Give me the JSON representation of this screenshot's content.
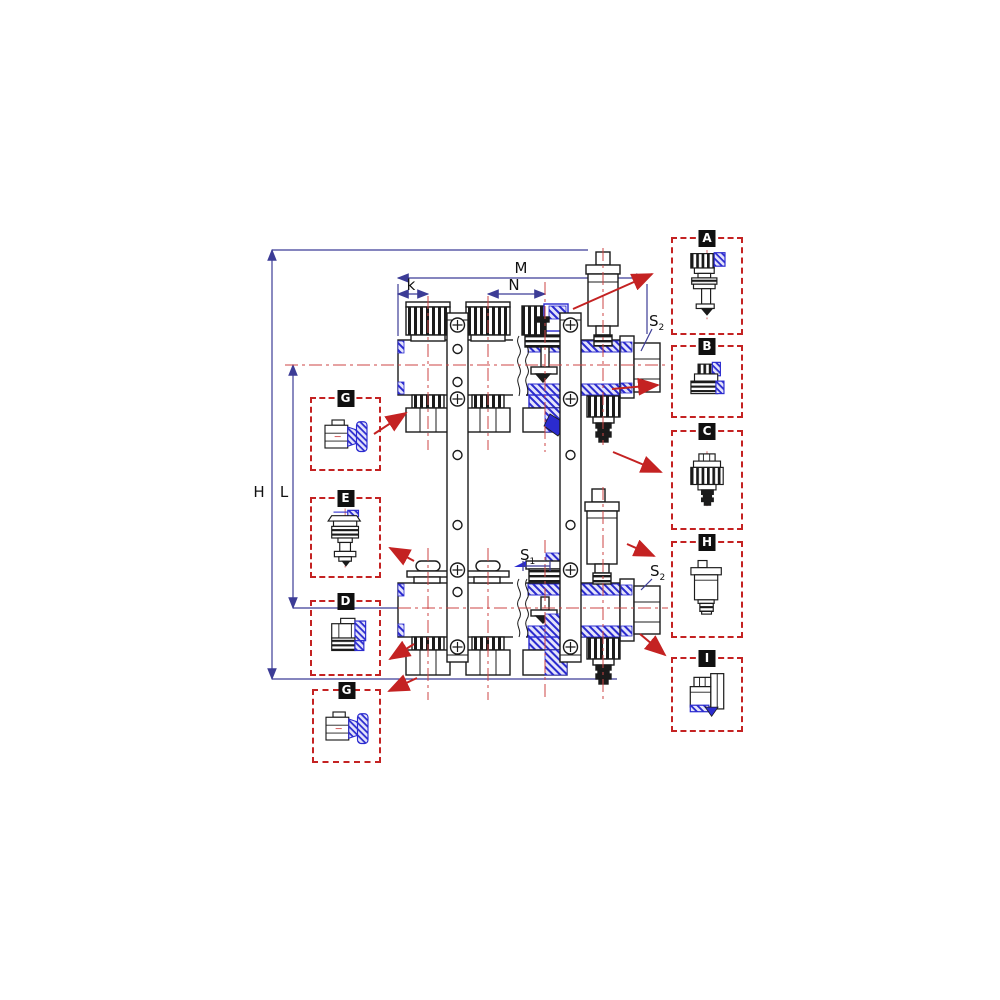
{
  "drawing": {
    "dimension_labels": {
      "h": "H",
      "l": "L",
      "m": "M",
      "n": "N",
      "k": "k",
      "s1": {
        "base": "S",
        "sub": "1"
      },
      "s2": {
        "base": "S",
        "sub": "2"
      }
    }
  },
  "callouts": {
    "left": [
      {
        "letter": "G",
        "icon": "eurocone-fitting-icon"
      },
      {
        "letter": "E",
        "icon": "valve-core-icon"
      },
      {
        "letter": "D",
        "icon": "male-union-icon"
      },
      {
        "letter": "G",
        "icon": "eurocone-fitting-icon"
      }
    ],
    "right": [
      {
        "letter": "A",
        "icon": "valve-insert-icon"
      },
      {
        "letter": "B",
        "icon": "reducer-adapter-icon"
      },
      {
        "letter": "C",
        "icon": "drain-valve-cap-icon"
      },
      {
        "letter": "H",
        "icon": "air-vent-icon"
      },
      {
        "letter": "I",
        "icon": "end-plug-icon"
      }
    ]
  },
  "colors": {
    "line_black": "#1b1b1b",
    "section_blue": "#2b2bcf",
    "dimension_blue": "#3c3c96",
    "callout_red": "#c42222",
    "centerline_red": "#cc4444",
    "background": "#ffffff"
  }
}
